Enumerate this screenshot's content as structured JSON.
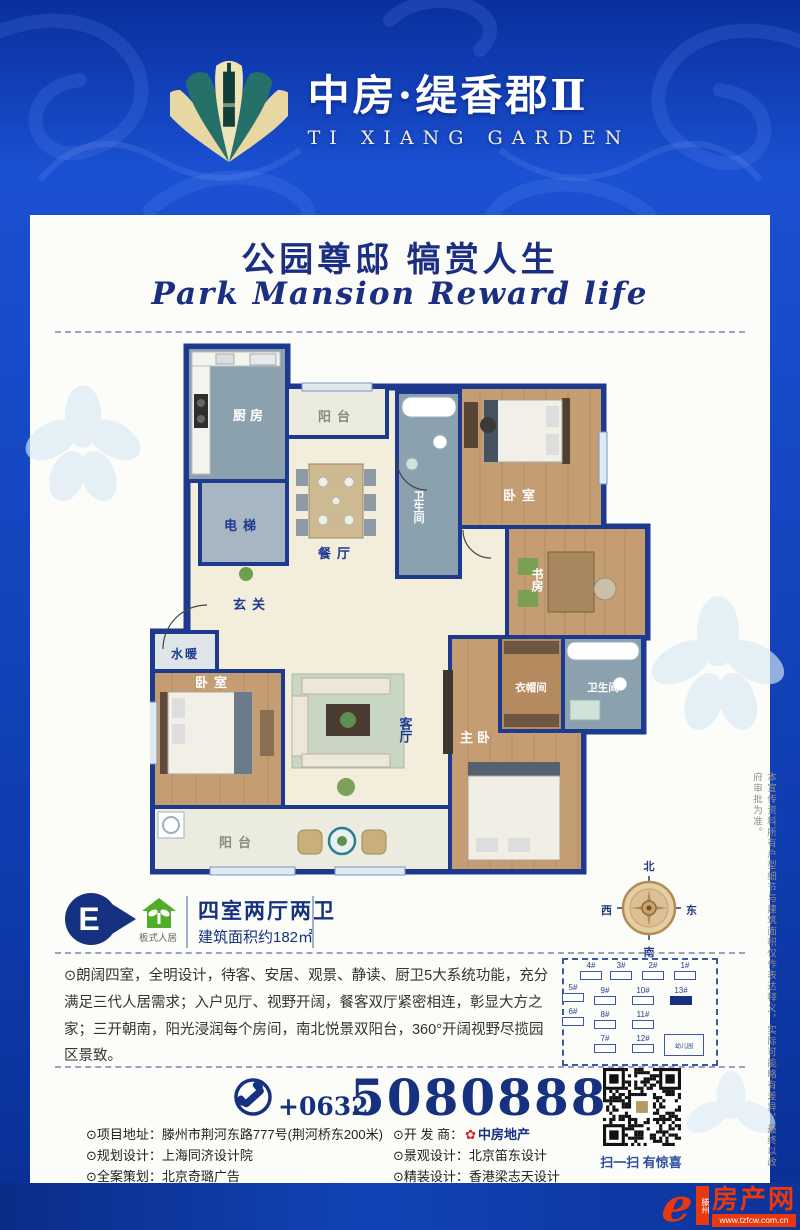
{
  "header": {
    "title": "中房·缇香郡Ⅱ",
    "subtitle": "TI XIANG GARDEN"
  },
  "slogan": {
    "cn": "公园尊邸 犒赏人生",
    "en": "Park Mansion Reward life"
  },
  "floorplan": {
    "kitchen": "厨房",
    "balcony_top": "阳台",
    "bath_top": "卫生间",
    "bedroom_top": "卧室",
    "elevator": "电梯",
    "dining": "餐厅",
    "entry": "玄关",
    "study": "书房",
    "plumbing": "水暖",
    "bedroom_left": "卧室",
    "living": "客厅",
    "cloakroom": "衣帽间",
    "bath_master": "卫生间",
    "master": "主卧",
    "balcony_bottom": "阳台"
  },
  "unit": {
    "badge": "E",
    "eco": "板式人居",
    "layout": "四室两厅两卫",
    "area": "建筑面积约182㎡"
  },
  "compass": {
    "n": "北",
    "s": "南",
    "e": "东",
    "w": "西"
  },
  "description": "⊙朗阔四室，全明设计，待客、安居、观景、静读、厨卫5大系统功能，充分满足三代人居需求；入户见厅、视野开阔，餐客双厅紧密相连，彰显大方之家；三开朝南，阳光浸润每个房间，南北悦景双阳台，360°开阔视野尽揽园区景致。",
  "siteplan": {
    "row1": [
      "4#",
      "3#",
      "2#",
      "1#"
    ],
    "row2": [
      "5#",
      "9#",
      "10#",
      "13#"
    ],
    "row3": [
      "6#",
      "8#",
      "11#"
    ],
    "row4": [
      "7#",
      "12#"
    ],
    "kindergarten": "幼儿园",
    "highlight": "13#"
  },
  "phone": {
    "prefix": "+0632",
    "number": "5080888"
  },
  "contact": {
    "address_label": "⊙项目地址：",
    "address": "滕州市荆河东路777号(荆河桥东200米)",
    "planning_label": "⊙规划设计：",
    "planning": "上海同济设计院",
    "agency_label": "⊙全案策划：",
    "agency": "北京奇璐广告",
    "developer_label": "⊙开 发 商：",
    "developer": "中房地产",
    "landscape_label": "⊙景观设计：",
    "landscape": "北京笛东设计",
    "interior_label": "⊙精装设计：",
    "interior": "香港梁志天设计"
  },
  "qr": {
    "caption": "扫一扫 有惊喜"
  },
  "footer": {
    "logo_e": "e",
    "region": "滕州",
    "site": "房产网",
    "url": "www.tzfcw.com.cn"
  },
  "disclaimer": "本宣传资料所有户型细节与建筑面积仅作表达释义，实际可能略有差异，最终以政府审批为准。",
  "icons": {
    "developer_flower": "✿"
  },
  "colors": {
    "navy_wall": "#1d3a8f",
    "accent_red": "#e8380d",
    "eco_green": "#4fae28",
    "brand_blue": "#16317f"
  }
}
